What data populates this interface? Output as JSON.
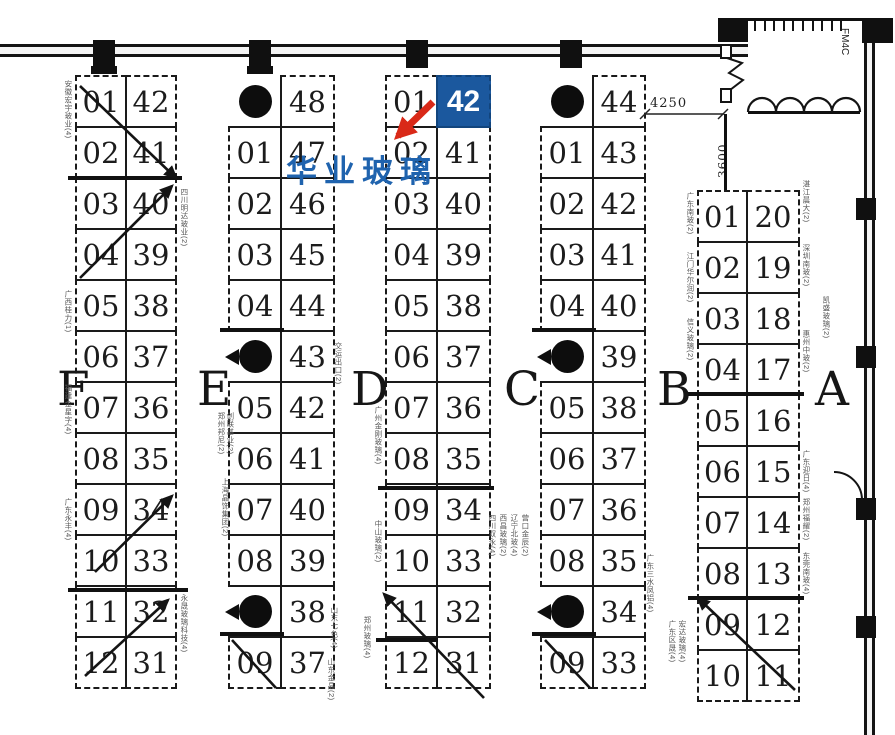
{
  "annotation": {
    "company_name": "华业玻璃",
    "booth_number": "42",
    "badge_color": "#1b589e",
    "company_color": "#1f63ae",
    "arrow_color": "#d92918"
  },
  "dimensions": {
    "width_label": "4250",
    "height_label": "3600",
    "door_label": "FM4C"
  },
  "sections": [
    {
      "letter": "F",
      "x": 57,
      "y": 366
    },
    {
      "letter": "E",
      "x": 197,
      "y": 366
    },
    {
      "letter": "D",
      "x": 351,
      "y": 366
    },
    {
      "letter": "C",
      "x": 504,
      "y": 366
    },
    {
      "letter": "B",
      "x": 657,
      "y": 366
    },
    {
      "letter": "A",
      "x": 815,
      "y": 366
    }
  ],
  "blocks": [
    {
      "id": "F",
      "x": 75,
      "y": 75,
      "wl": 50,
      "wr": 50,
      "rh": 51,
      "rows": [
        [
          "01",
          "42",
          ""
        ],
        [
          "02",
          "41",
          ""
        ],
        [
          "03",
          "40",
          ""
        ],
        [
          "04",
          "39",
          ""
        ],
        [
          "05",
          "38",
          ""
        ],
        [
          "06",
          "37",
          ""
        ],
        [
          "07",
          "36",
          ""
        ],
        [
          "08",
          "35",
          ""
        ],
        [
          "09",
          "34",
          ""
        ],
        [
          "10",
          "33",
          ""
        ],
        [
          "11",
          "32",
          ""
        ],
        [
          "12",
          "31",
          ""
        ]
      ]
    },
    {
      "id": "E",
      "x": 228,
      "y": 75,
      "wl": 52,
      "wr": 53,
      "rh": 51,
      "rows": [
        [
          null,
          "48",
          "p"
        ],
        [
          "01",
          "47",
          ""
        ],
        [
          "02",
          "46",
          ""
        ],
        [
          "03",
          "45",
          ""
        ],
        [
          "04",
          "44",
          ""
        ],
        [
          null,
          "43",
          "pn"
        ],
        [
          "05",
          "42",
          ""
        ],
        [
          "06",
          "41",
          ""
        ],
        [
          "07",
          "40",
          ""
        ],
        [
          "08",
          "39",
          ""
        ],
        [
          null,
          "38",
          "pn"
        ],
        [
          "09",
          "37",
          ""
        ]
      ]
    },
    {
      "id": "D",
      "x": 385,
      "y": 75,
      "wl": 51,
      "wr": 53,
      "rh": 51,
      "rows": [
        [
          "01",
          "42",
          "hl"
        ],
        [
          "02",
          "41",
          ""
        ],
        [
          "03",
          "40",
          ""
        ],
        [
          "04",
          "39",
          ""
        ],
        [
          "05",
          "38",
          ""
        ],
        [
          "06",
          "37",
          ""
        ],
        [
          "07",
          "36",
          ""
        ],
        [
          "08",
          "35",
          ""
        ],
        [
          "09",
          "34",
          ""
        ],
        [
          "10",
          "33",
          ""
        ],
        [
          "11",
          "32",
          ""
        ],
        [
          "12",
          "31",
          ""
        ]
      ]
    },
    {
      "id": "C",
      "x": 540,
      "y": 75,
      "wl": 52,
      "wr": 52,
      "rh": 51,
      "rows": [
        [
          null,
          "44",
          "p"
        ],
        [
          "01",
          "43",
          ""
        ],
        [
          "02",
          "42",
          ""
        ],
        [
          "03",
          "41",
          ""
        ],
        [
          "04",
          "40",
          ""
        ],
        [
          null,
          "39",
          "pn"
        ],
        [
          "05",
          "38",
          ""
        ],
        [
          "06",
          "37",
          ""
        ],
        [
          "07",
          "36",
          ""
        ],
        [
          "08",
          "35",
          ""
        ],
        [
          null,
          "34",
          "pn"
        ],
        [
          "09",
          "33",
          ""
        ]
      ]
    },
    {
      "id": "B",
      "x": 697,
      "y": 190,
      "wl": 49,
      "wr": 52,
      "rh": 51,
      "rows": [
        [
          "01",
          "20",
          ""
        ],
        [
          "02",
          "19",
          ""
        ],
        [
          "03",
          "18",
          ""
        ],
        [
          "04",
          "17",
          ""
        ],
        [
          "05",
          "16",
          ""
        ],
        [
          "06",
          "15",
          ""
        ],
        [
          "07",
          "14",
          ""
        ],
        [
          "08",
          "13",
          ""
        ],
        [
          "09",
          "12",
          ""
        ],
        [
          "10",
          "11",
          ""
        ]
      ]
    }
  ],
  "aisle_walls": [
    [
      68,
      176,
      114,
      4
    ],
    [
      68,
      588,
      120,
      4
    ],
    [
      220,
      328,
      64,
      4
    ],
    [
      220,
      632,
      64,
      4
    ],
    [
      378,
      486,
      116,
      4
    ],
    [
      376,
      638,
      62,
      4
    ],
    [
      532,
      328,
      64,
      4
    ],
    [
      532,
      632,
      64,
      4
    ],
    [
      688,
      392,
      116,
      4
    ],
    [
      688,
      596,
      116,
      4
    ]
  ],
  "crossed_arrows": [
    [
      80,
      86,
      176,
      178,
      1
    ],
    [
      80,
      278,
      172,
      186,
      1
    ],
    [
      95,
      572,
      172,
      496,
      1
    ],
    [
      85,
      676,
      168,
      600,
      1
    ],
    [
      232,
      640,
      276,
      688,
      0
    ],
    [
      484,
      698,
      384,
      594,
      1
    ],
    [
      545,
      640,
      590,
      688,
      0
    ],
    [
      795,
      690,
      698,
      598,
      1
    ]
  ],
  "pointer_arrow": [
    433,
    102,
    398,
    136
  ],
  "exhibitor_labels": [
    [
      64,
      80,
      "安徽宏宇玻业(4)"
    ],
    [
      64,
      290,
      "广西桂力(1)"
    ],
    [
      64,
      384,
      "福建金星字(4)"
    ],
    [
      64,
      498,
      "广东永丰(4)"
    ],
    [
      180,
      188,
      "四川明达玻业(2)"
    ],
    [
      180,
      594,
      "永晟玻璃科技(4)"
    ],
    [
      217,
      412,
      "郑州邦尼(2)"
    ],
    [
      226,
      412,
      "创联基业(2)"
    ],
    [
      221,
      478,
      "上海晶饰集团(2)"
    ],
    [
      334,
      342,
      "交运出口(2)"
    ],
    [
      330,
      606,
      "山东七色(4)"
    ],
    [
      327,
      658,
      "山东金晶(2)"
    ],
    [
      374,
      406,
      "广州金刚玻璃(4)"
    ],
    [
      374,
      520,
      "中山玻璃(2)"
    ],
    [
      363,
      616,
      "郑州玻璃(4)"
    ],
    [
      488,
      514,
      "四川双永(4)"
    ],
    [
      499,
      514,
      "西昌玻璃(2)"
    ],
    [
      510,
      514,
      "辽宁北玻(4)"
    ],
    [
      521,
      514,
      "营口金辰(2)"
    ],
    [
      646,
      554,
      "广东三水凤铝(4)"
    ],
    [
      668,
      620,
      "广东区晟(4)"
    ],
    [
      678,
      620,
      "宏达玻璃(4)"
    ],
    [
      686,
      192,
      "广东南玻(2)"
    ],
    [
      686,
      252,
      "江门华尔润(2)"
    ],
    [
      686,
      318,
      "信义玻璃(2)"
    ],
    [
      802,
      180,
      "湛江晨大(2)"
    ],
    [
      802,
      244,
      "深圳南玻(2)"
    ],
    [
      802,
      330,
      "惠州中玻(2)"
    ],
    [
      802,
      450,
      "广东迎日(4)"
    ],
    [
      802,
      498,
      "郑州福耀(2)"
    ],
    [
      802,
      552,
      "东莞南玻(4)"
    ],
    [
      822,
      296,
      "凯盛玻璃(2)"
    ]
  ]
}
